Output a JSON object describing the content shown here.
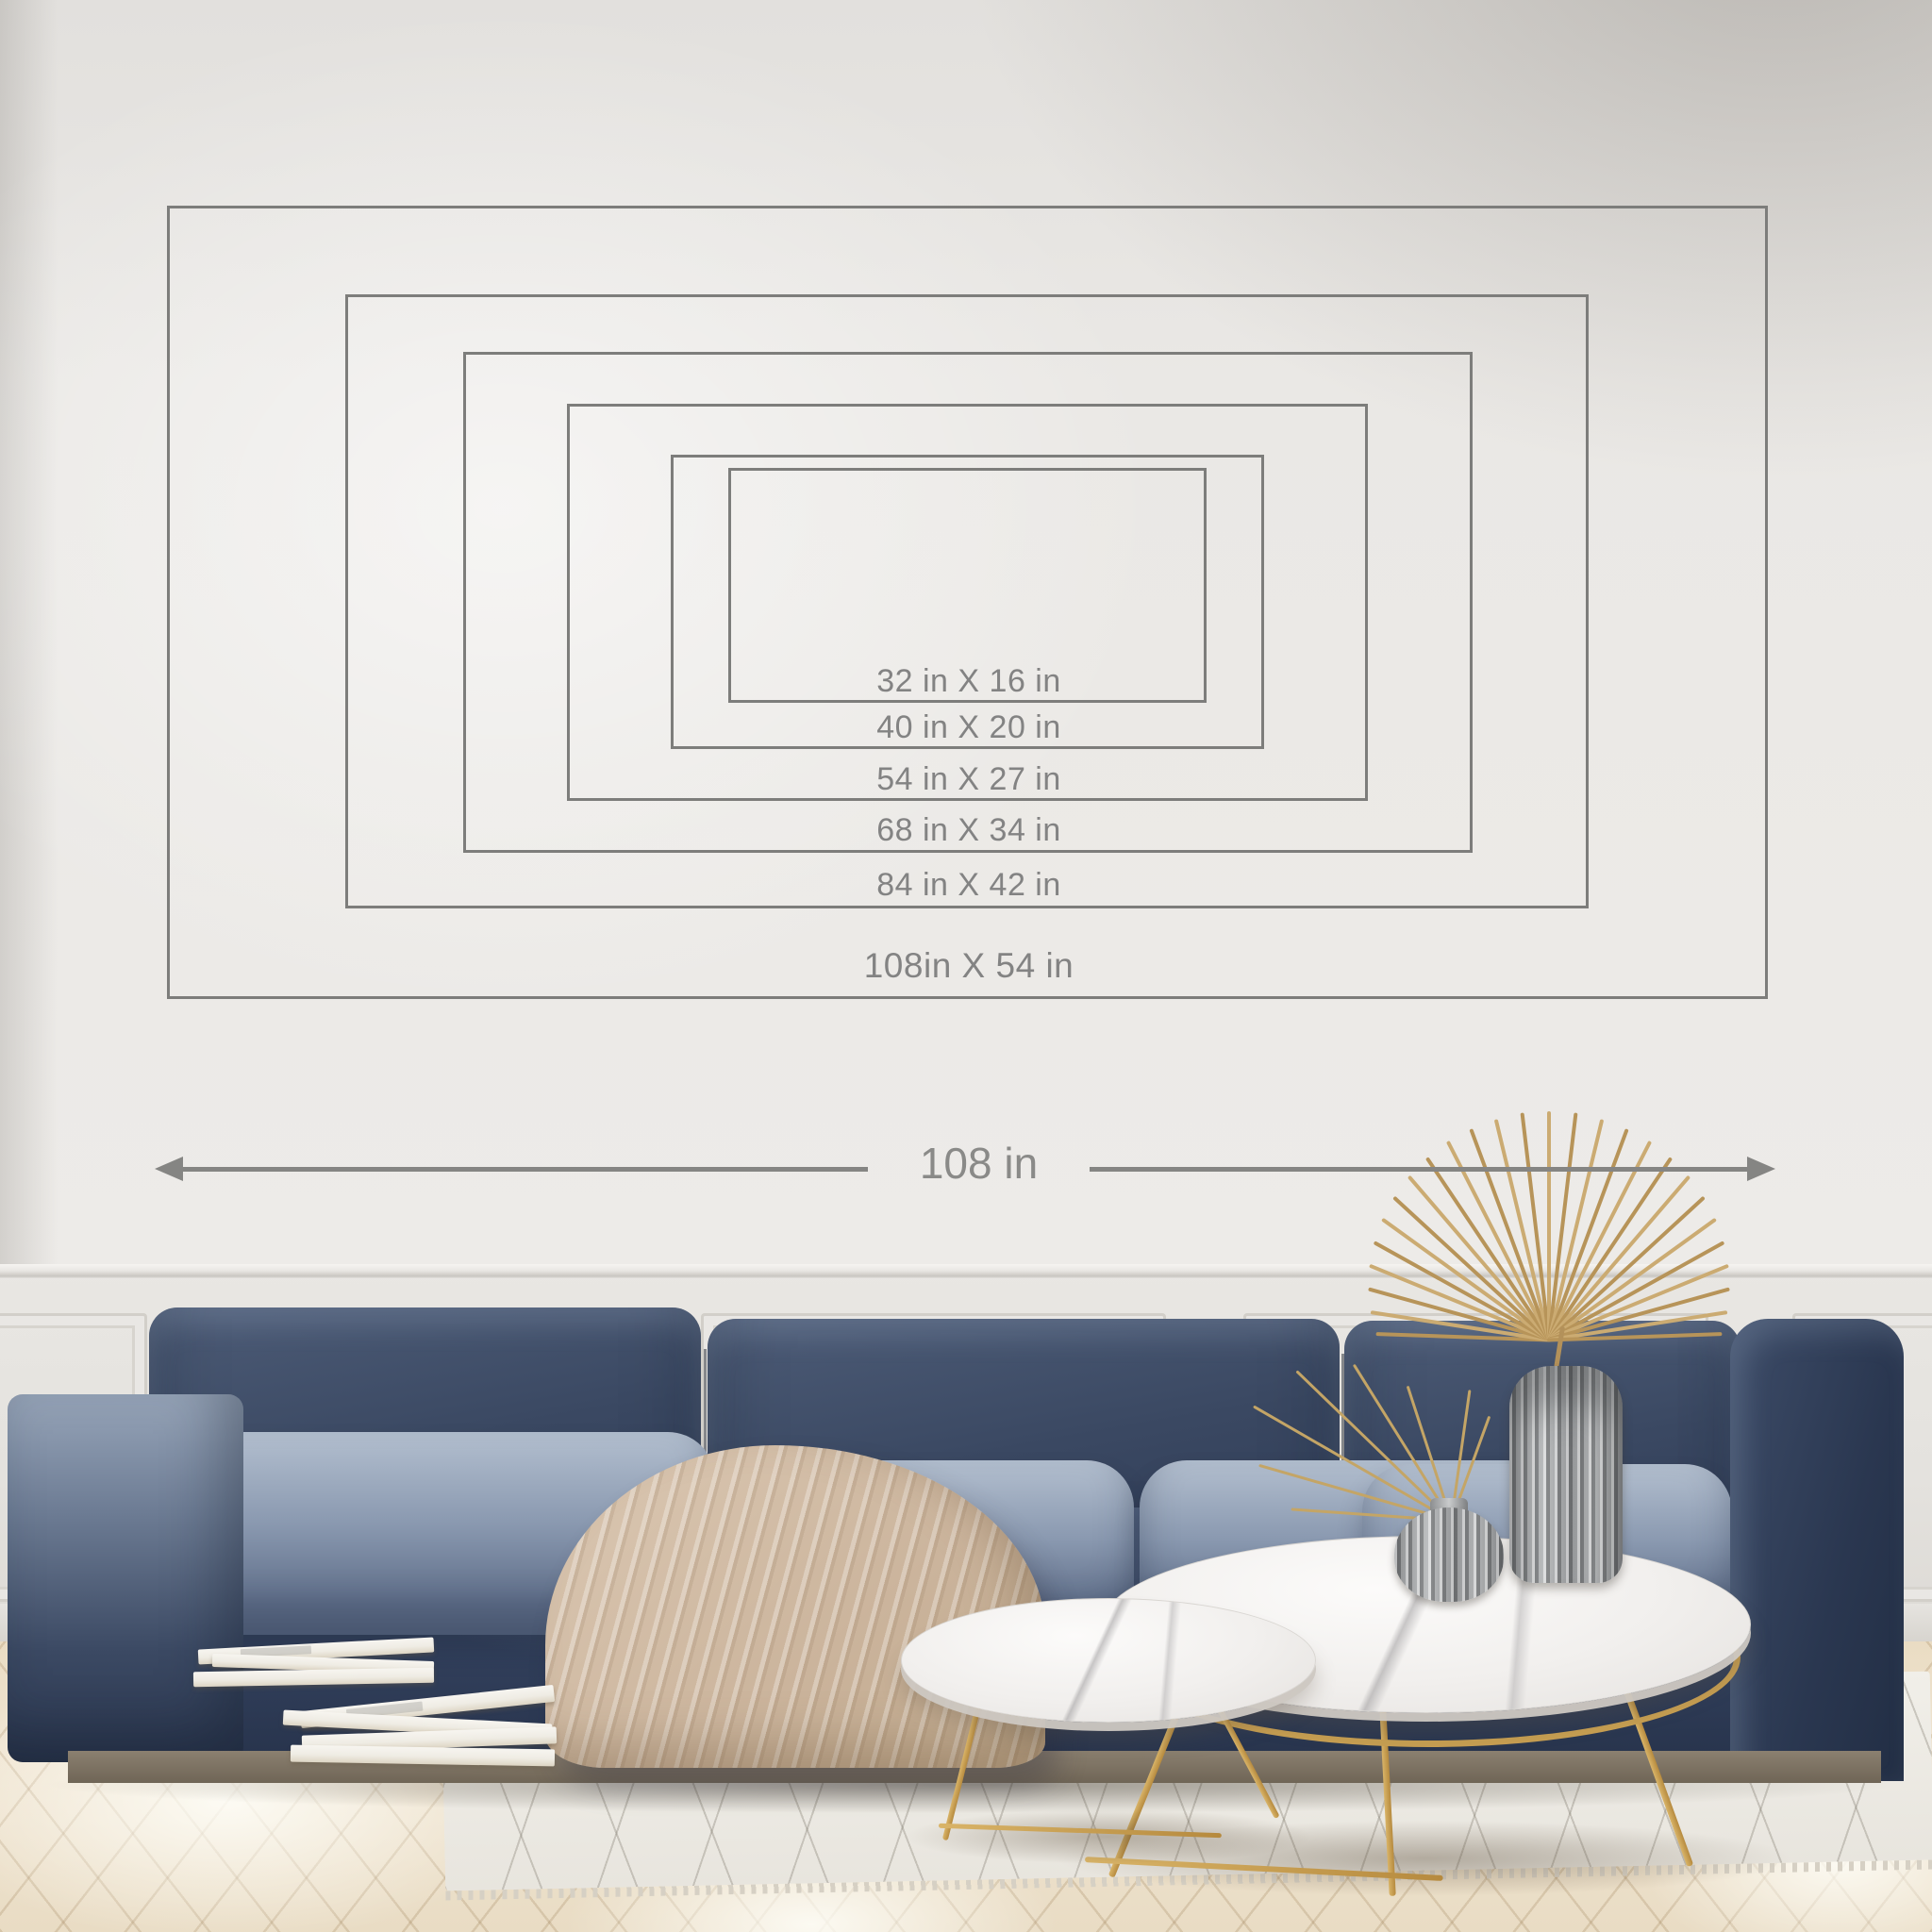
{
  "size_chart": {
    "unit": "in",
    "sizes": [
      {
        "label": "32 in X 16 in",
        "width_in": 32,
        "height_in": 16
      },
      {
        "label": "40 in X 20 in",
        "width_in": 40,
        "height_in": 20
      },
      {
        "label": "54 in X 27 in",
        "width_in": 54,
        "height_in": 27
      },
      {
        "label": "68 in X 34 in",
        "width_in": 68,
        "height_in": 34
      },
      {
        "label": "84 in X 42 in",
        "width_in": 84,
        "height_in": 42
      },
      {
        "label": "108in X 54 in",
        "width_in": 108,
        "height_in": 54
      }
    ],
    "width_arrow": {
      "label": "108 in",
      "total_width_in": 108
    }
  },
  "style": {
    "outline_color": "#7d7d7b",
    "label_color": "#838383",
    "arrow_color": "#858583",
    "wall_color": "#e9e7e3",
    "sofa_navy": "#32405c",
    "cushion_highlight": "#b3bfcf",
    "blanket_beige": "#cdb8a3",
    "table_gold": "#c79f52",
    "marble_white": "#f1efed",
    "floor_wood": "#ecdfc8"
  },
  "scene": {
    "objects": [
      "wall",
      "wainscoting",
      "herringbone-floor",
      "area-rug",
      "navy-velvet-sofa",
      "left-ottoman",
      "knit-throw-blanket",
      "stacked-books",
      "marble-coffee-table-large",
      "marble-coffee-table-small",
      "round-glass-vase",
      "tall-fluted-glass-vase",
      "dried-palm-fan",
      "dried-grass"
    ]
  }
}
